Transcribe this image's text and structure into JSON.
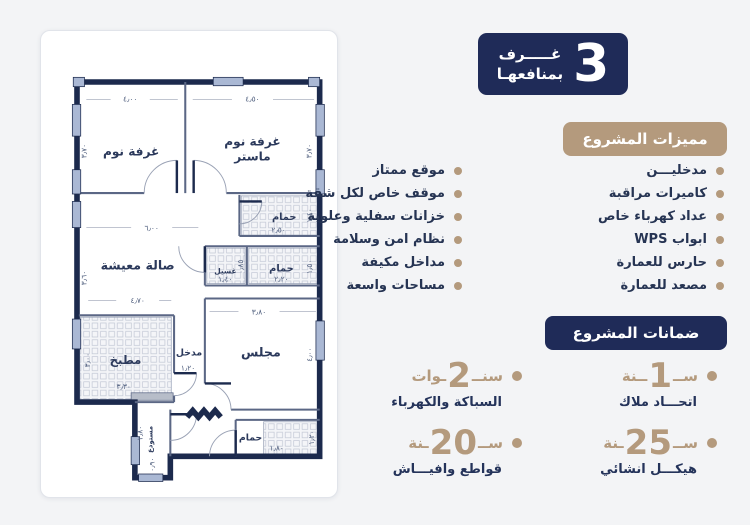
{
  "colors": {
    "navy": "#1f2b58",
    "tan": "#b49a7d",
    "text_navy": "#263453",
    "wall": "#1c2a4d",
    "window_blue": "#aab8d4"
  },
  "rooms_badge": {
    "number": "3",
    "line1": "غـــــرف",
    "line2": "بمنافعهـا"
  },
  "features": {
    "title": "مميزات المشروع",
    "column_right": [
      "مدخليـــن",
      "كاميرات مراقبة",
      "عداد كهرباء خاص",
      "ابواب WPS",
      "حارس للعمارة",
      "مصعد للعمارة"
    ],
    "column_left": [
      "موقع ممتاز",
      "موقف خاص لكل شقة",
      "خزانات سفلية وعلوية",
      "نظام امن وسلامة",
      "مداخل مكيفة",
      "مساحات واسعة"
    ]
  },
  "guarantees": {
    "title": "ضمانات المشروع",
    "items": [
      {
        "prefix": "ســ",
        "number": "1",
        "suffix": "ــنة",
        "label": "اتحـــاد ملاك"
      },
      {
        "prefix": "سنــ",
        "number": "2",
        "suffix": "ـوات",
        "label": "السباكة والكهرباء"
      },
      {
        "prefix": "ســ",
        "number": "25",
        "suffix": "ـنة",
        "label": "هيكـــل انشائي"
      },
      {
        "prefix": "ســ",
        "number": "20",
        "suffix": "ـنة",
        "label": "قواطع وافيـــاش"
      }
    ]
  },
  "floorplan": {
    "rooms": {
      "bedroom": "غرفة نوم",
      "master_line1": "غرفة نوم",
      "master_line2": "ماستر",
      "living": "صالة معيشة",
      "majlis": "مجلس",
      "kitchen": "مطبخ",
      "entry": "مدخل",
      "storage": "مستودع",
      "bath": "حمام",
      "laundry": "غسيل"
    },
    "dims": {
      "bedroom_w": "٤٫٠٠",
      "master_w": "٤٫٥٠",
      "bedroom_h": "٣٫٧٠",
      "master_h": "٣٫٧٠",
      "living_w": "٦٫٠٠",
      "living_h": "٣٫٦٠",
      "kitchen_top": "٤٫٧٠",
      "kitchen_w": "٣٫٣٠",
      "kitchen_h": "٣٫٠٠",
      "bath1_w": "٢٫٥٠",
      "bath1_h": "١٫٤٠",
      "laundry_w": "١٫٤٠",
      "passage": "٠٫٨٥",
      "bath2_w": "٢٫٢٠",
      "bath2_h": "١٫٥٠",
      "majlis_w": "٣٫٨٠",
      "majlis_h": "٤٫٠٠",
      "entry_w": "١٫٢٠",
      "bath3_w": "١٫٨٠",
      "bath3_h": "١٫٢٠",
      "corridor_h": "٢٫٨٠",
      "corridor_w": "٠٫٩٠"
    }
  }
}
